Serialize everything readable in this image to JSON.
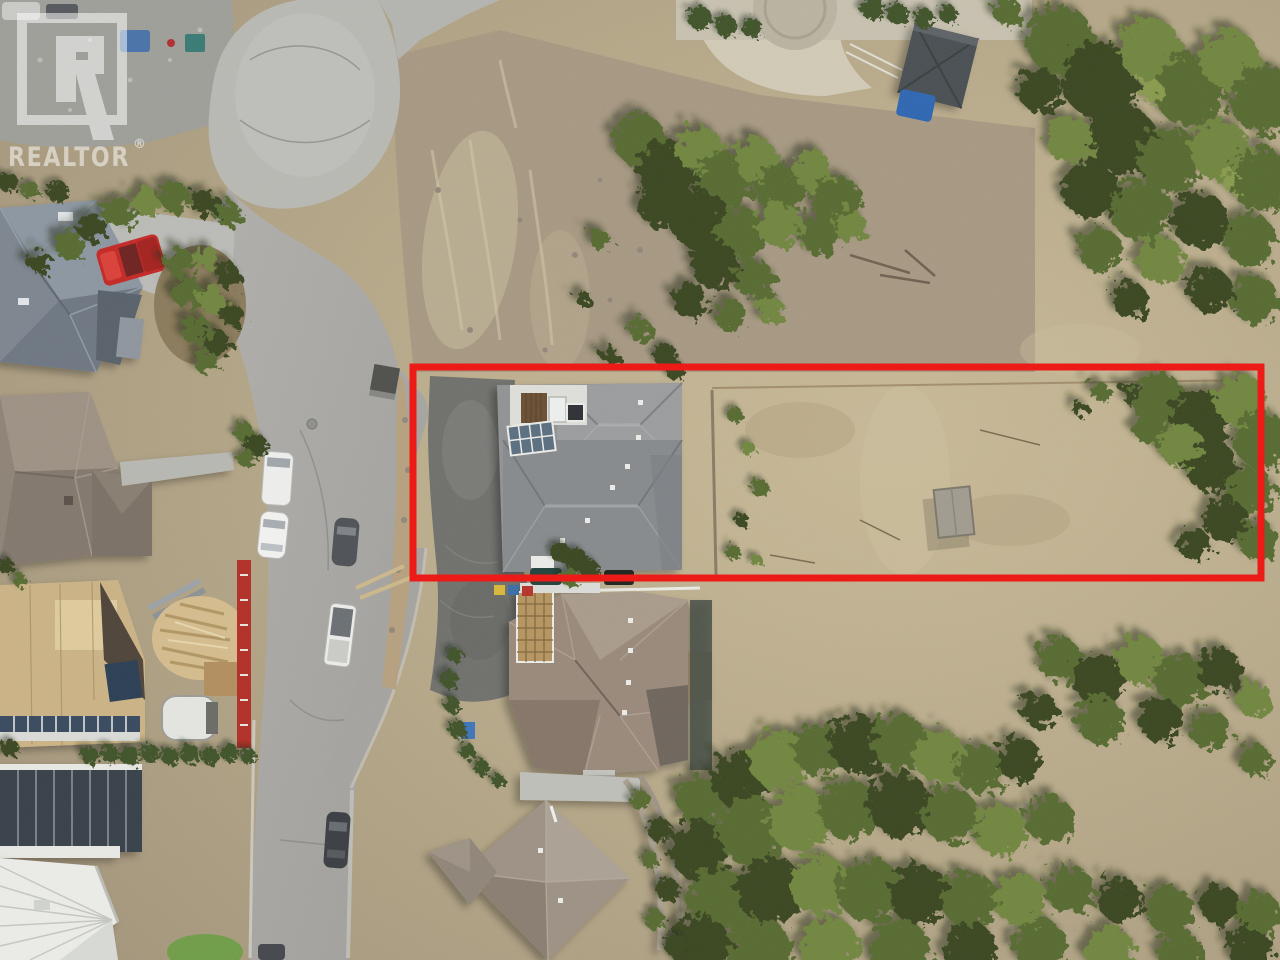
{
  "image": {
    "type": "aerial-drone-photograph",
    "description": "Overhead drone photo of a hillside cul-de-sac neighbourhood; a long vacant lot beside an existing home is outlined in red",
    "width_px": 1280,
    "height_px": 960
  },
  "watermark": {
    "icon": "realtor-logo-icon",
    "text": "REALTOR",
    "registered_mark": "®",
    "color": "#ffffff"
  },
  "overlay": {
    "name": "lot-boundary",
    "shape": "rectangle",
    "color": "#ed1b17"
  },
  "scene": {
    "palette": {
      "scrub": "#b3a586",
      "slope_dirt": "#a59781",
      "forest_green": "#566b33",
      "road_asphalt": "#a8a7a3",
      "culdesac_concrete": "#b7b7b2",
      "driveway_asphalt": "#6f706c",
      "roof_gray": "#8f9193",
      "roof_taupe": "#8d8276",
      "roof_brown_gray": "#98887a",
      "plywood": "#c9b184",
      "truck_red": "#c22a27"
    },
    "features": [
      "cul-de-sac",
      "street",
      "gravel-pad",
      "house-topleft",
      "house-left",
      "construction-site",
      "modern-house-bottomleft",
      "metal-roof-house",
      "subject-house",
      "house-below-lot",
      "house-bottom",
      "vacant-lot",
      "wood-platform",
      "gazebo",
      "patio-garden",
      "pine-forest",
      "red-pickup-truck",
      "white-van",
      "white-car",
      "gray-car",
      "white-pickup",
      "dark-suv"
    ]
  }
}
